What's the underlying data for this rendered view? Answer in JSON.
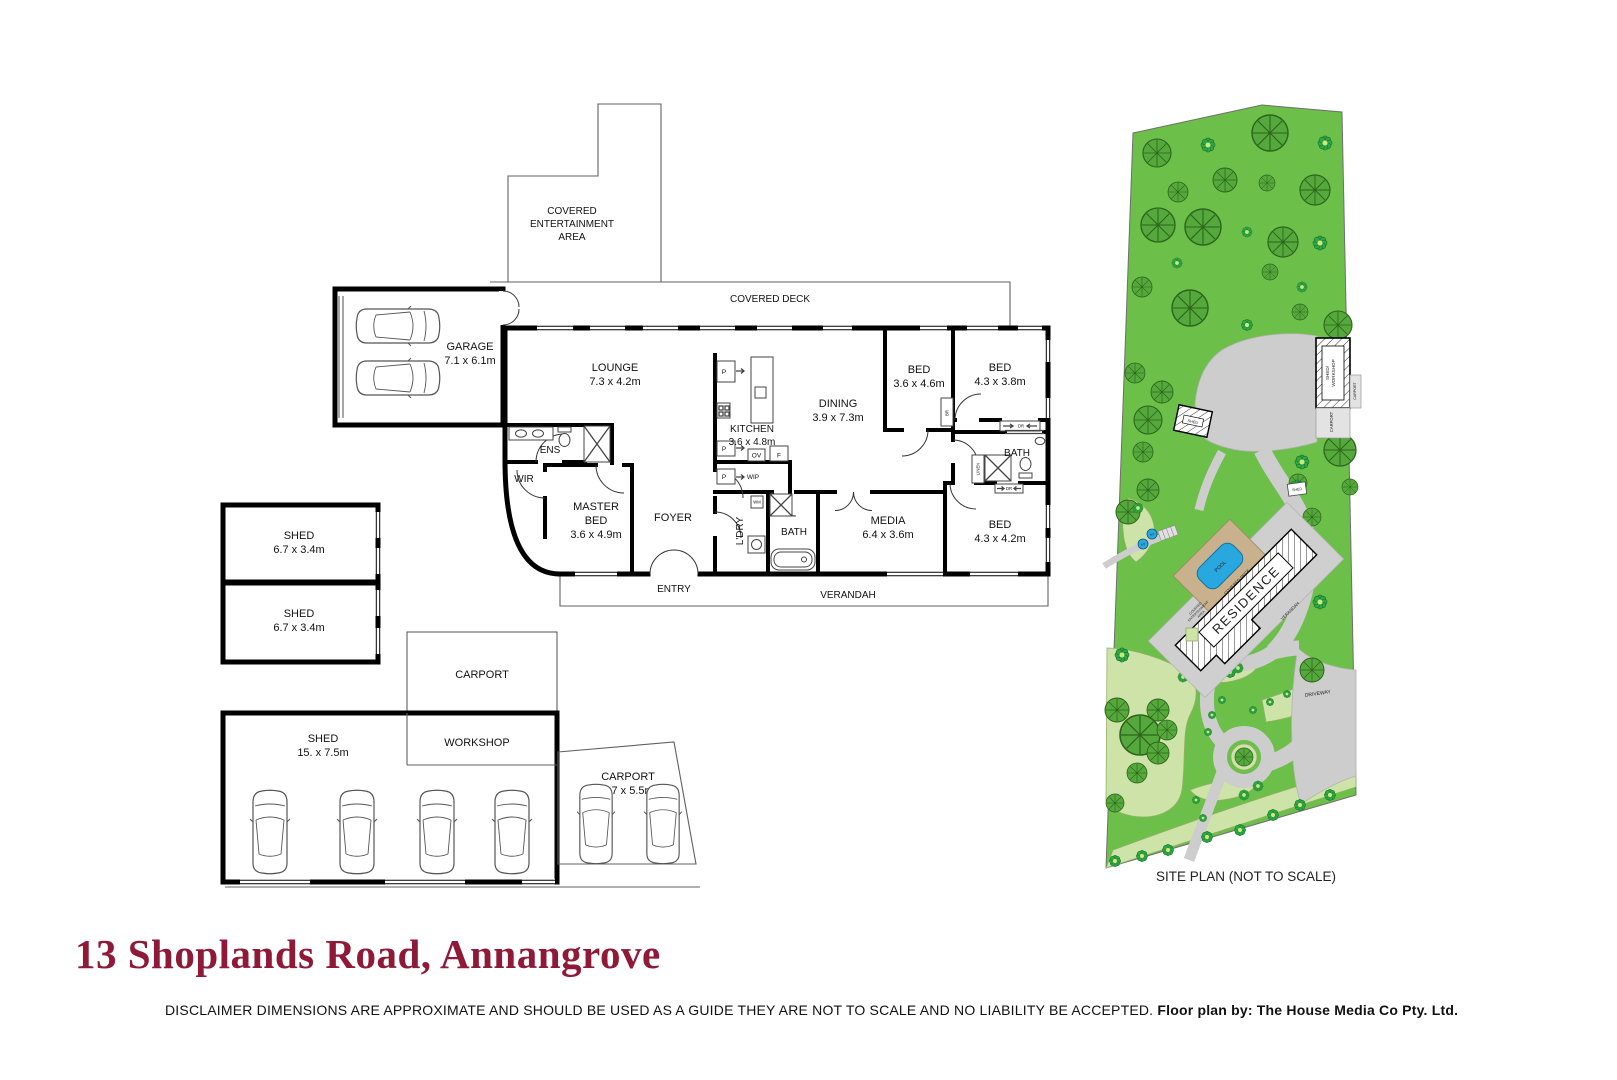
{
  "page": {
    "title": "13 Shoplands Road, Annangrove"
  },
  "disclaimer": {
    "text": "DISCLAIMER DIMENSIONS ARE APPROXIMATE AND SHOULD BE USED AS A GUIDE THEY ARE NOT TO SCALE AND NO LIABILITY BE ACCEPTED. ",
    "credit": "Floor plan by: The House Media Co Pty. Ltd."
  },
  "colors": {
    "title_text": "#8E1A38",
    "grass": "#6CBF48",
    "garden_bed": "#CDE3A7",
    "tree": "#55A83B",
    "tree_line": "#2C651C",
    "bush": "#2FA844",
    "bush_center": "#CFE87E",
    "driveway": "#CDCDCD",
    "pool_water": "#29A8E0",
    "pool_deck": "#C9B18D",
    "wall": "#000000"
  },
  "floorplan": {
    "outdoor": {
      "covered_entertainment": [
        "COVERED",
        "ENTERTAINMENT",
        "AREA"
      ],
      "covered_deck": "COVERED DECK",
      "verandah": "VERANDAH",
      "entry": "ENTRY"
    },
    "rooms": {
      "garage": {
        "name": "GARAGE",
        "dims": "7.1 x 6.1m"
      },
      "lounge": {
        "name": "LOUNGE",
        "dims": "7.3 x 4.2m"
      },
      "kitchen": {
        "name": "KITCHEN",
        "dims": "3.6 x 4.8m"
      },
      "dining": {
        "name": "DINING",
        "dims": "3.9 x 7.3m"
      },
      "bed1": {
        "name": "BED",
        "dims": "3.6 x 4.6m"
      },
      "bed2": {
        "name": "BED",
        "dims": "4.3 x 3.8m"
      },
      "bed3": {
        "name": "BED",
        "dims": "4.3 x 4.2m"
      },
      "bath1": {
        "name": "BATH"
      },
      "bath2": {
        "name": "BATH"
      },
      "media": {
        "name": "MEDIA",
        "dims": "6.4 x 3.6m"
      },
      "master": {
        "line1": "MASTER",
        "line2": "BED",
        "dims": "3.6 x 4.9m"
      },
      "foyer": {
        "name": "FOYER"
      },
      "ens": {
        "name": "ENS"
      },
      "wir": {
        "name": "WIR"
      },
      "ldry": {
        "name": "L'DRY"
      },
      "wip": {
        "name": "WIP"
      }
    },
    "fixtures": {
      "pantry": "P",
      "oven": "OV",
      "fridge": "F",
      "washer": "WM",
      "robe": "BR",
      "sliding_robe": "DR",
      "linen": "LINEN"
    },
    "outbuildings": {
      "shed1": {
        "name": "SHED",
        "dims": "6.7 x 3.4m"
      },
      "shed2": {
        "name": "SHED",
        "dims": "6.7 x 3.4m"
      },
      "carport1": {
        "name": "CARPORT"
      },
      "big_shed": {
        "name": "SHED",
        "dims": "15. x 7.5m"
      },
      "workshop": {
        "name": "WORKSHOP"
      },
      "carport2": {
        "name": "CARPORT",
        "dims": "7.7 x 5.5m"
      }
    }
  },
  "siteplan": {
    "caption": "SITE PLAN (NOT TO SCALE)",
    "labels": {
      "residence": "RESIDENCE",
      "pool": "POOL",
      "covered_deck": "COVERED DECK",
      "verandah": "VERANDAH",
      "covered_entertainment": [
        "COVERED",
        "ENTERTAINMENT",
        "AREA"
      ],
      "shed_workshop": [
        "SHED/",
        "WORKSHOP"
      ],
      "carport": "CARPORT",
      "shed": "SHED",
      "driveway": "DRIVEWAY",
      "water_tank": "WT"
    }
  }
}
